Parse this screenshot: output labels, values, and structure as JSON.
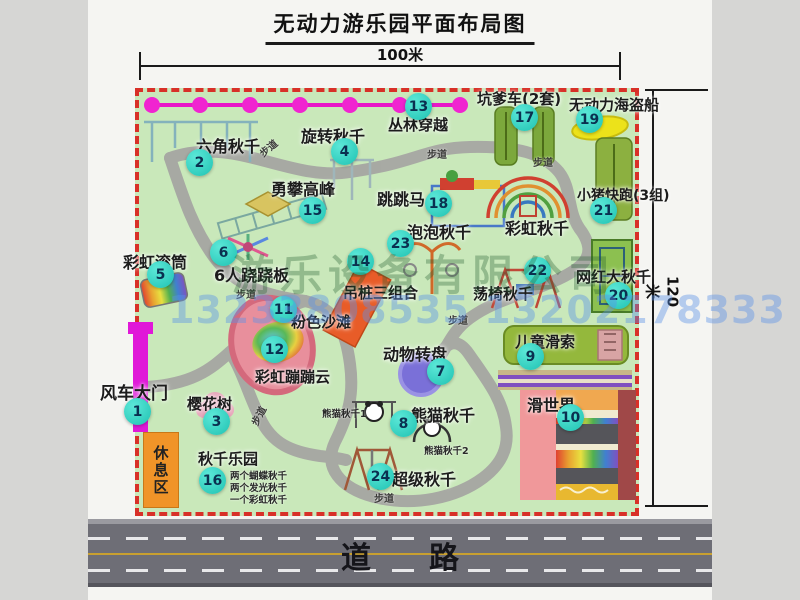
{
  "title": "无动力游乐园平面布局图",
  "dims": {
    "w": "100米",
    "h": "120米"
  },
  "road": {
    "label": "道路"
  },
  "watermark": {
    "company": "游乐设备有限公司",
    "phone": "13233808535 13202178333"
  },
  "map": {
    "path_label": "步道",
    "rest_area": "休息区",
    "rainbow_swing": "彩虹秋千",
    "items": [
      {
        "num": "1",
        "label": "风车大门"
      },
      {
        "num": "2",
        "label": "六角秋千"
      },
      {
        "num": "3",
        "label": "樱花树"
      },
      {
        "num": "4",
        "label": "旋转秋千"
      },
      {
        "num": "5",
        "label": "彩虹滚筒"
      },
      {
        "num": "6",
        "label": "6人跷跷板"
      },
      {
        "num": "7",
        "label": "动物转盘"
      },
      {
        "num": "8",
        "label": "熊猫秋千"
      },
      {
        "num": "9",
        "label": "儿童滑索"
      },
      {
        "num": "10",
        "label": "滑世界"
      },
      {
        "num": "11",
        "label": "粉色沙滩"
      },
      {
        "num": "12",
        "label": "彩虹蹦蹦云"
      },
      {
        "num": "13",
        "label": "丛林穿越"
      },
      {
        "num": "14",
        "label": "吊桩三组合"
      },
      {
        "num": "15",
        "label": "勇攀高峰"
      },
      {
        "num": "16",
        "label": "秋千乐园"
      },
      {
        "num": "17",
        "label": "坑爹车(2套)"
      },
      {
        "num": "18",
        "label": "跳跳马"
      },
      {
        "num": "19",
        "label": "无动力海盗船"
      },
      {
        "num": "20",
        "label": "网红大秋千"
      },
      {
        "num": "21",
        "label": "小猪快跑(3组)"
      },
      {
        "num": "22",
        "label": "荡椅秋千"
      },
      {
        "num": "23",
        "label": "泡泡秋千"
      },
      {
        "num": "24",
        "label": "超级秋千"
      }
    ],
    "notes": {
      "panda1": "熊猫秋千1",
      "panda2": "熊猫秋千2",
      "swing_park": [
        "两个蝴蝶秋千",
        "两个发光秋千",
        "一个彩虹秋千"
      ]
    }
  }
}
